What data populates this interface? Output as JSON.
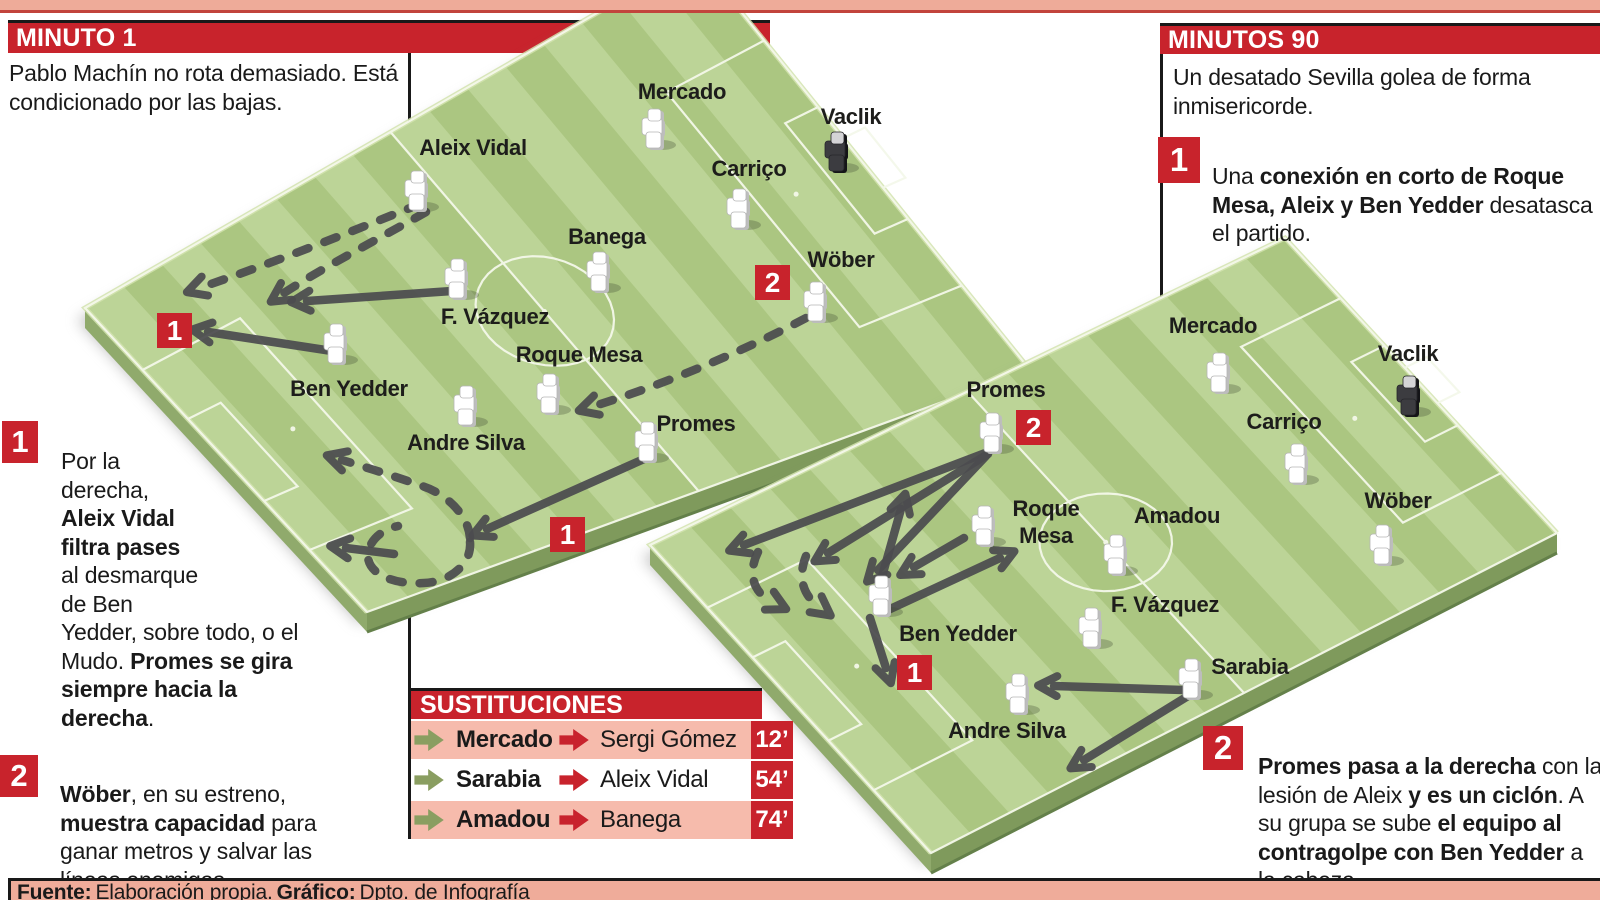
{
  "header_left": {
    "title": "MINUTO 1",
    "description": "Pablo Machín no rota demasiado. Está condicionado por las bajas."
  },
  "header_right": {
    "title": "MINUTOS 90",
    "description": "Un desatado Sevilla golea de forma inmisericorde."
  },
  "notes": {
    "left1": {
      "num": "1",
      "seg1": "Por la derecha, ",
      "seg2": "Aleix Vidal filtra pases",
      "seg3": " al desmarque de Ben Yedder, sobre todo, o el Mudo. ",
      "seg4": "Promes se gira siempre hacia la derecha",
      "seg5": "."
    },
    "left2": {
      "num": "2",
      "seg1": "Wöber",
      "seg2": ", en su estreno, ",
      "seg3": "muestra capacidad",
      "seg4": " para ganar metros y salvar las líneas enemigas."
    },
    "right1": {
      "num": "1",
      "seg1": "Una ",
      "seg2": "conexión en corto de Roque Mesa, Aleix y Ben Yedder",
      "seg3": " desatasca el partido."
    },
    "right2": {
      "num": "2",
      "seg1": "Promes pasa a la derecha",
      "seg2": " con la lesión de Aleix ",
      "seg3": "y es un ciclón",
      "seg4": ". A su grupa se sube ",
      "seg5": "el equipo al contragolpe con Ben Yedder",
      "seg6": " a la cabeza."
    }
  },
  "substitutions": {
    "title": "SUSTITUCIONES",
    "rows": [
      {
        "out": "Mercado",
        "in": "Sergi Gómez",
        "minute": "12’"
      },
      {
        "out": "Sarabia",
        "in": "Aleix Vidal",
        "minute": "54’"
      },
      {
        "out": "Amadou",
        "in": "Banega",
        "minute": "74’"
      }
    ]
  },
  "footer": {
    "label1": "Fuente:",
    "text1": "Elaboración propia.",
    "label2": "Gráfico:",
    "text2": "Dpto. de Infografía"
  },
  "colors": {
    "red": "#c8232c",
    "salmon": "#eeab99",
    "pink_row": "#f6bbac",
    "grass_light": "#bcd497",
    "grass_dark": "#abc681",
    "pitch_side_front": "#7f9a5c",
    "pitch_side_left": "#90aa6c",
    "pitch_rim": "#d2e3ae",
    "line_white": "#f4f8ea",
    "arrow_gray": "#4c4c4f",
    "ink": "#1d1d1b",
    "sub_out_green": "#8a9e61",
    "keeper_dark": "#3c3c40"
  },
  "pitches": [
    {
      "name": "pitch-minute-1",
      "quad": [
        [
          85,
          308
        ],
        [
          696,
          -44
        ],
        [
          1030,
          370
        ],
        [
          367,
          612
        ]
      ],
      "badges": [
        {
          "num": "1",
          "x": 157,
          "y": 313
        },
        {
          "num": "1",
          "x": 550,
          "y": 517
        },
        {
          "num": "2",
          "x": 755,
          "y": 265
        }
      ],
      "players": [
        {
          "name": "Aleix Vidal",
          "fx": 416,
          "fy": 210,
          "lx": 473,
          "ly": 155
        },
        {
          "name": "Mercado",
          "fx": 653,
          "fy": 148,
          "lx": 682,
          "ly": 99
        },
        {
          "name": "Vaclik",
          "keeper": true,
          "fx": 836,
          "fy": 171,
          "lx": 851,
          "ly": 124
        },
        {
          "name": "Carriço",
          "fx": 738,
          "fy": 228,
          "lx": 749,
          "ly": 176
        },
        {
          "name": "Banega",
          "fx": 598,
          "fy": 291,
          "lx": 607,
          "ly": 244
        },
        {
          "name": "Wöber",
          "fx": 815,
          "fy": 321,
          "lx": 841,
          "ly": 267
        },
        {
          "name": "F. Vázquez",
          "fx": 456,
          "fy": 298,
          "lx": 495,
          "ly": 324
        },
        {
          "name": "Roque Mesa",
          "fx": 548,
          "fy": 413,
          "lx": 579,
          "ly": 362
        },
        {
          "name": "Ben Yedder",
          "fx": 335,
          "fy": 363,
          "lx": 349,
          "ly": 396
        },
        {
          "name": "Andre Silva",
          "fx": 465,
          "fy": 425,
          "lx": 466,
          "ly": 450
        },
        {
          "name": "Promes",
          "fx": 646,
          "fy": 461,
          "lx": 696,
          "ly": 431
        }
      ],
      "arrows": [
        {
          "style": "dashed",
          "d": "M 420,204 C 360,228 276,262 202,287"
        },
        {
          "style": "dashed",
          "d": "M 426,212 C 384,236 322,268 284,293"
        },
        {
          "style": "solid",
          "d": "M 452,291 L 307,301"
        },
        {
          "style": "solid",
          "d": "M 332,351 L 208,332"
        },
        {
          "style": "solid",
          "d": "M 644,459 L 487,529"
        },
        {
          "style": "dashed",
          "d": "M 806,318 C 742,352 660,386 594,406"
        },
        {
          "style": "dashed",
          "d": "M 470,538 C 468,512 442,492 422,486 C 400,478 368,468 342,460"
        },
        {
          "style": "dashed",
          "head": false,
          "d": "M 470,542 C 472,564 450,582 424,583 C 394,585 368,574 368,556 C 368,542 380,530 398,526"
        },
        {
          "style": "solid",
          "d": "M 394,554 L 346,548"
        }
      ]
    },
    {
      "name": "pitch-minutes-90",
      "quad": [
        [
          650,
          545
        ],
        [
          1285,
          238
        ],
        [
          1557,
          533
        ],
        [
          931,
          853
        ]
      ],
      "badges": [
        {
          "num": "2",
          "x": 1016,
          "y": 410
        },
        {
          "num": "1",
          "x": 897,
          "y": 655
        }
      ],
      "players": [
        {
          "name": "Promes",
          "fx": 991,
          "fy": 452,
          "lx": 1006,
          "ly": 397
        },
        {
          "name": "Mercado",
          "fx": 1218,
          "fy": 392,
          "lx": 1213,
          "ly": 333
        },
        {
          "name": "Vaclik",
          "keeper": true,
          "fx": 1408,
          "fy": 415,
          "lx": 1408,
          "ly": 361
        },
        {
          "name": "Carriço",
          "fx": 1296,
          "fy": 483,
          "lx": 1284,
          "ly": 429
        },
        {
          "name": "Roque Mesa",
          "lines": [
            "Roque",
            "Mesa"
          ],
          "fx": 983,
          "fy": 545,
          "lx": 1046,
          "ly": 516
        },
        {
          "name": "Amadou",
          "fx": 1115,
          "fy": 574,
          "lx": 1177,
          "ly": 523
        },
        {
          "name": "Wöber",
          "fx": 1381,
          "fy": 564,
          "lx": 1398,
          "ly": 508
        },
        {
          "name": "F. Vázquez",
          "fx": 1090,
          "fy": 647,
          "lx": 1165,
          "ly": 612
        },
        {
          "name": "Ben Yedder",
          "fx": 880,
          "fy": 615,
          "lx": 958,
          "ly": 641
        },
        {
          "name": "Sarabia",
          "fx": 1190,
          "fy": 698,
          "lx": 1250,
          "ly": 674
        },
        {
          "name": "Andre Silva",
          "fx": 1017,
          "fy": 713,
          "lx": 1007,
          "ly": 738
        }
      ],
      "arrows": [
        {
          "style": "solid",
          "d": "M 988,452 L 744,545"
        },
        {
          "style": "solid",
          "d": "M 988,454 L 828,553"
        },
        {
          "style": "solid",
          "d": "M 986,456 L 878,570"
        },
        {
          "style": "solid",
          "d": "M 876,598 L 901,509"
        },
        {
          "style": "solid",
          "d": "M 964,538 L 914,567"
        },
        {
          "style": "solid",
          "d": "M 888,610 L 1000,558"
        },
        {
          "style": "solid",
          "d": "M 870,618 L 886,668"
        },
        {
          "style": "dashed",
          "d": "M 758,552 C 748,572 752,592 772,602"
        },
        {
          "style": "dashed",
          "d": "M 806,556 C 798,576 802,594 818,606"
        },
        {
          "style": "solid",
          "d": "M 1183,690 L 1054,686"
        },
        {
          "style": "solid",
          "d": "M 1188,696 L 1084,760"
        }
      ]
    }
  ]
}
